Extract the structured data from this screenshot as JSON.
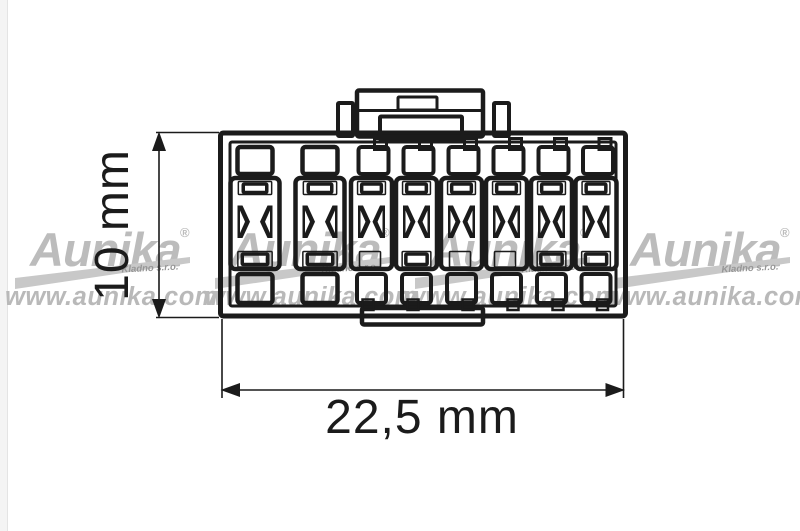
{
  "figure": {
    "type": "connector-dimension-diagram",
    "labels": {
      "height_dimension": "10 mm",
      "width_dimension": "22,5 mm"
    },
    "connector": {
      "pin_columns": 8,
      "wide_columns": 2,
      "narrow_columns": 6,
      "top_holes": 8,
      "bottom_holes": 8,
      "contact_slots": 8
    }
  },
  "watermark": {
    "brand": "Aunika",
    "registered_mark": "®",
    "subtitle": "Kladno s.r.o.",
    "url": "www.aunika.com"
  },
  "colors": {
    "line": "#1b1b1b",
    "background": "#ffffff",
    "watermark_text": "#bcbcbc",
    "watermark_url": "#b9b9b9",
    "watermark_swoosh": "#c8c8c8",
    "watermark_subtitle": "#969696"
  }
}
